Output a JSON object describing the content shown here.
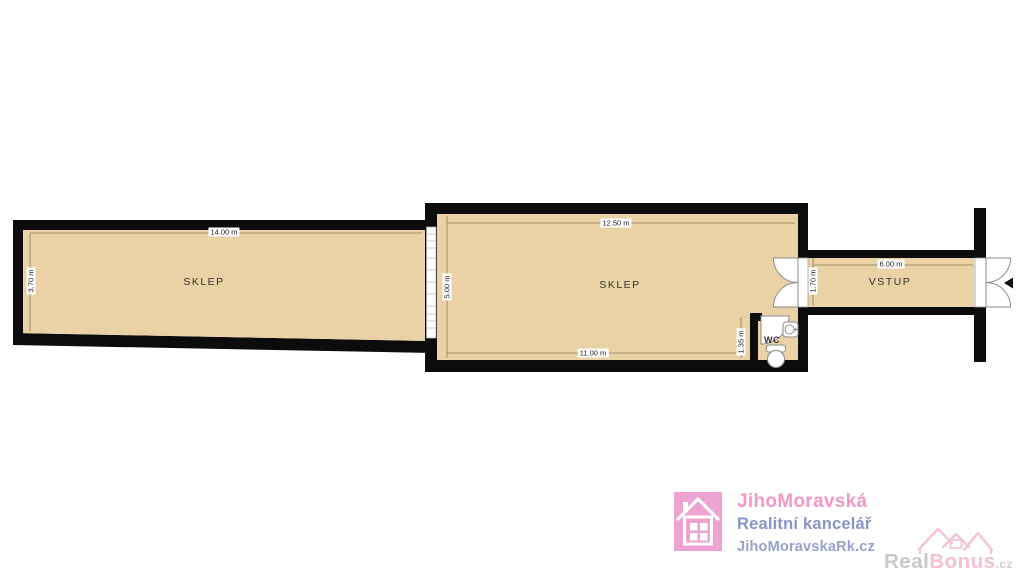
{
  "plan": {
    "rooms": [
      {
        "name": "SKLEP",
        "dim_top": "14.00 m",
        "dim_left": "3.70 m"
      },
      {
        "name": "SKLEP",
        "dim_top": "12.50 m",
        "dim_left": "5.00 m",
        "dim_bottom": "11.00 m"
      },
      {
        "name": "WC",
        "dim_left": "1.35 m"
      },
      {
        "name": "VSTUP",
        "dim_top": "6.00 m",
        "dim_left": "1.70 m"
      }
    ],
    "colors": {
      "floor": "#ebd2a6",
      "wall": "#0c0c0c",
      "dim_line": "#8a7b55",
      "fixture_stroke": "#8a8a8a"
    }
  },
  "branding": {
    "agency_name": "JihoMoravská",
    "agency_subtitle": "Realitní kancelář",
    "agency_website": "JihoMoravskaRk.cz",
    "agency_colors": {
      "pink": "#f399c5",
      "blue": "#8b94c6",
      "blue_light": "#96a1cf",
      "square": "#eda4d1"
    },
    "watermark_part1": "Real",
    "watermark_part2": "Bonus",
    "watermark_part3": ".cz",
    "watermark_colors": {
      "grey": "#c8c8c8",
      "pink": "#f3c0d4"
    }
  }
}
